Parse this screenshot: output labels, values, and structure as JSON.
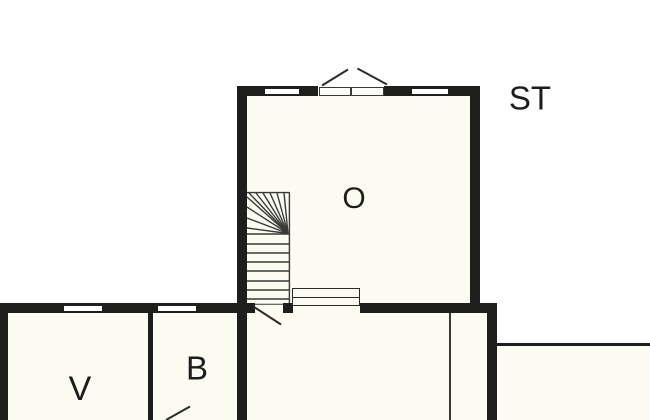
{
  "plan": {
    "type": "floor-plan",
    "rooms": [
      {
        "id": "o",
        "label": "O"
      },
      {
        "id": "v",
        "label": "V"
      },
      {
        "id": "b",
        "label": "B"
      }
    ],
    "annotations": [
      {
        "id": "st",
        "label": "ST"
      }
    ],
    "features": [
      "winder-staircase",
      "double-entry-door",
      "interior-steps",
      "four-windows",
      "two-door-swings",
      "terrace"
    ]
  },
  "colors": {
    "wall": "#1e1e1c",
    "thin_line": "#3a3a38",
    "room_fill": "#fcfbf2",
    "background": "#ffffff"
  }
}
